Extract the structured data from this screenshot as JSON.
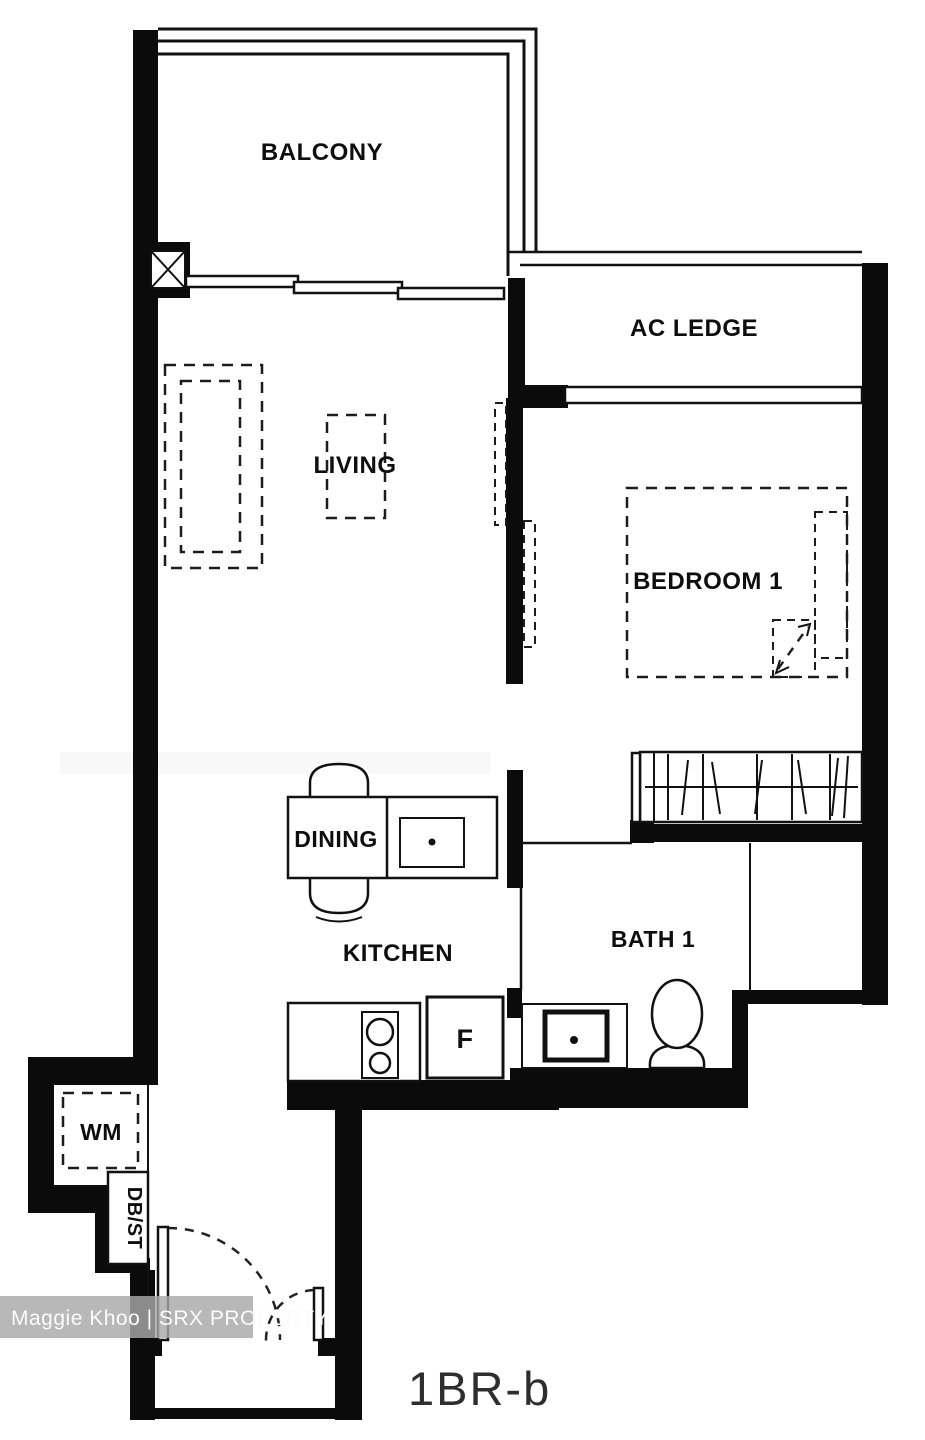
{
  "plan": {
    "unit_type_label": "1BR-b",
    "watermark_text": "Maggie Khoo | SRX PROPERTY",
    "rooms": {
      "balcony": "BALCONY",
      "ac_ledge": "AC LEDGE",
      "living": "LIVING",
      "bedroom1": "BEDROOM 1",
      "dining": "DINING",
      "kitchen": "KITCHEN",
      "bath1": "BATH 1"
    },
    "fixtures": {
      "fridge_label": "F",
      "washing_machine_label": "WM",
      "db_store_label": "DB/ST"
    },
    "colors": {
      "wall": "#0b0b0b",
      "line": "#111111",
      "watermark_bg": "#a8a8a8",
      "watermark_text": "#fbfbfb",
      "title_text": "#2e2e2e",
      "background": "#ffffff"
    }
  }
}
